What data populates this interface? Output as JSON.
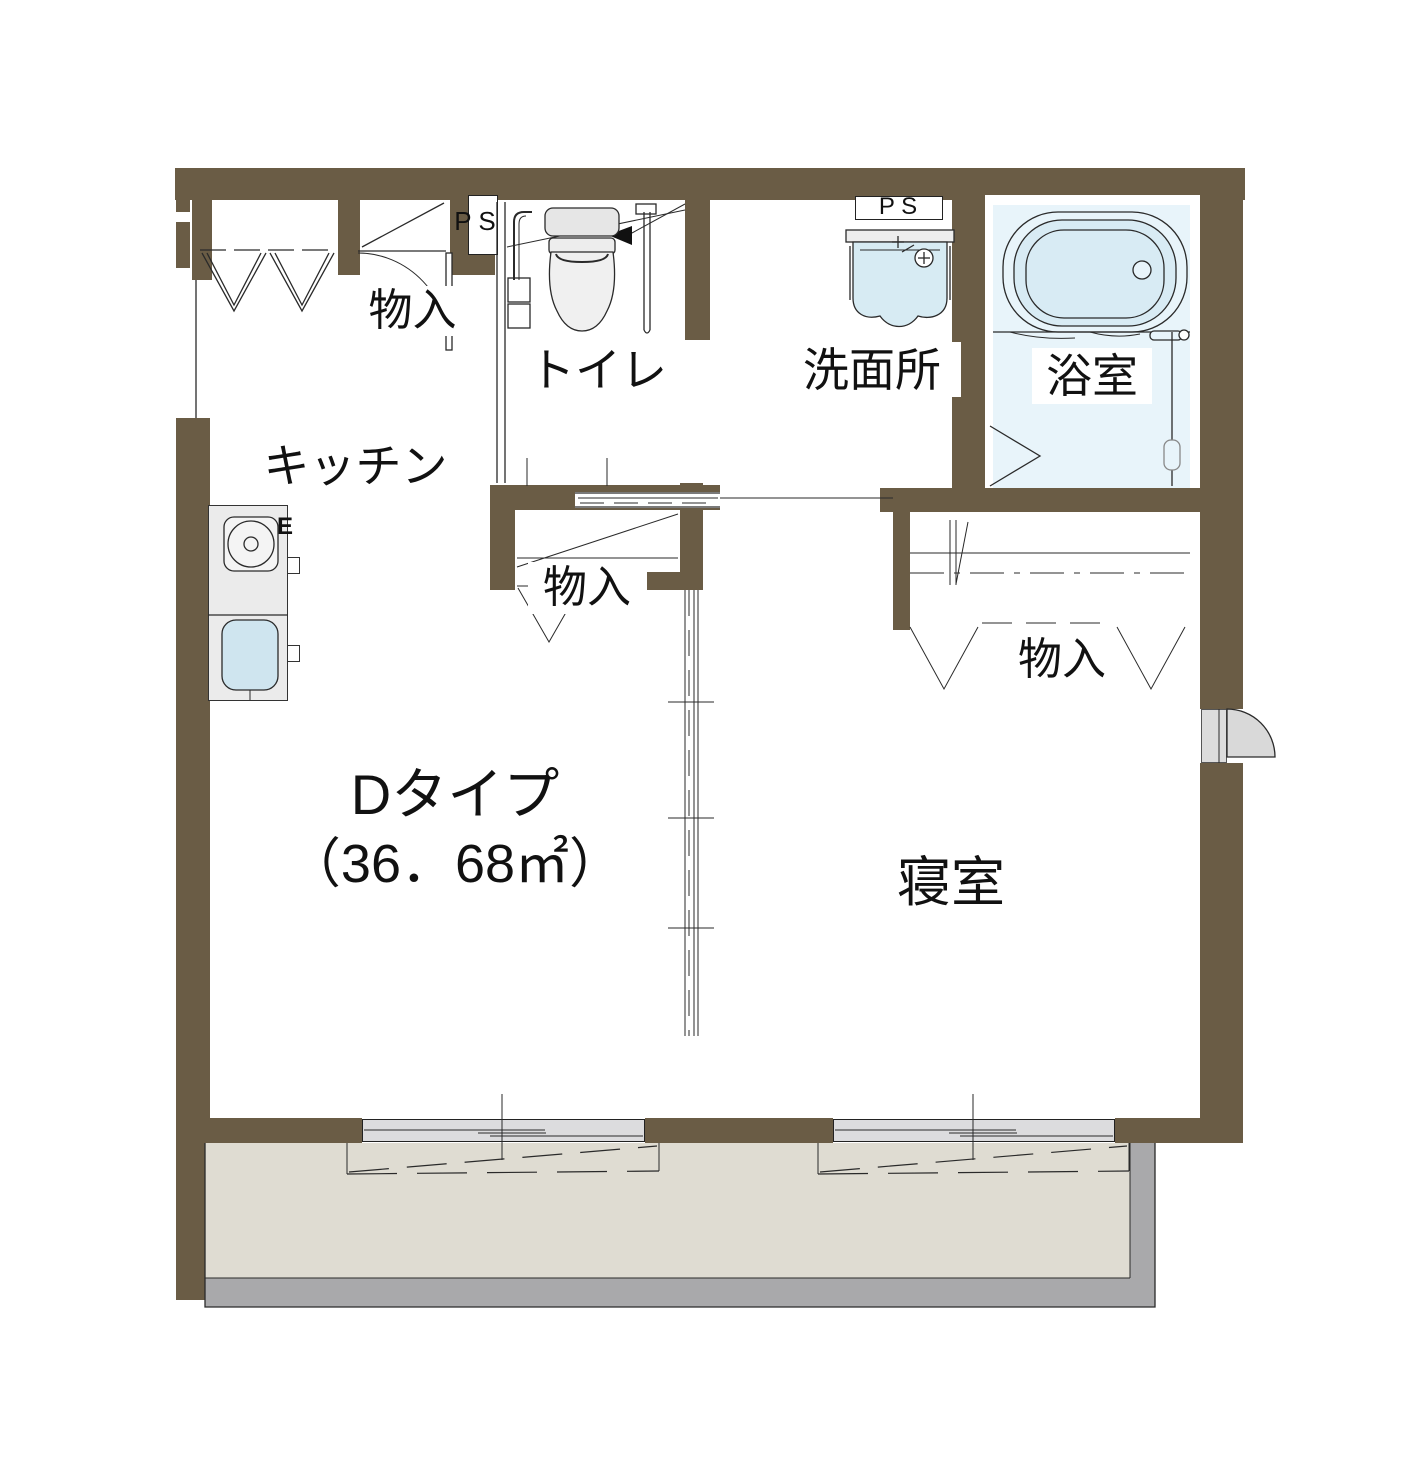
{
  "plan": {
    "unit_type": "Dタイプ",
    "unit_area": "（36．68㎡）",
    "rooms": {
      "kitchen": "キッチン",
      "toilet": "トイレ",
      "washroom": "洗面所",
      "bathroom": "浴室",
      "bedroom": "寝室"
    },
    "closets": {
      "entry": "物入",
      "hall": "物入",
      "bedroom": "物入"
    },
    "pipe_spaces": {
      "left": "P S",
      "right": "P S"
    },
    "stove_label": "E",
    "colors": {
      "wall": "#6A5C45",
      "bath_floor": "#E8F4FA",
      "tub_fill": "#D8EBF4",
      "sink_fill": "#CFE5EF",
      "window_fill": "#DCDCDE",
      "balcony_floor": "#DFDCD2",
      "balcony_edge": "#A9A9AB",
      "door_fill": "#D9D9D9",
      "counter_fill": "#EBEBEB"
    }
  }
}
